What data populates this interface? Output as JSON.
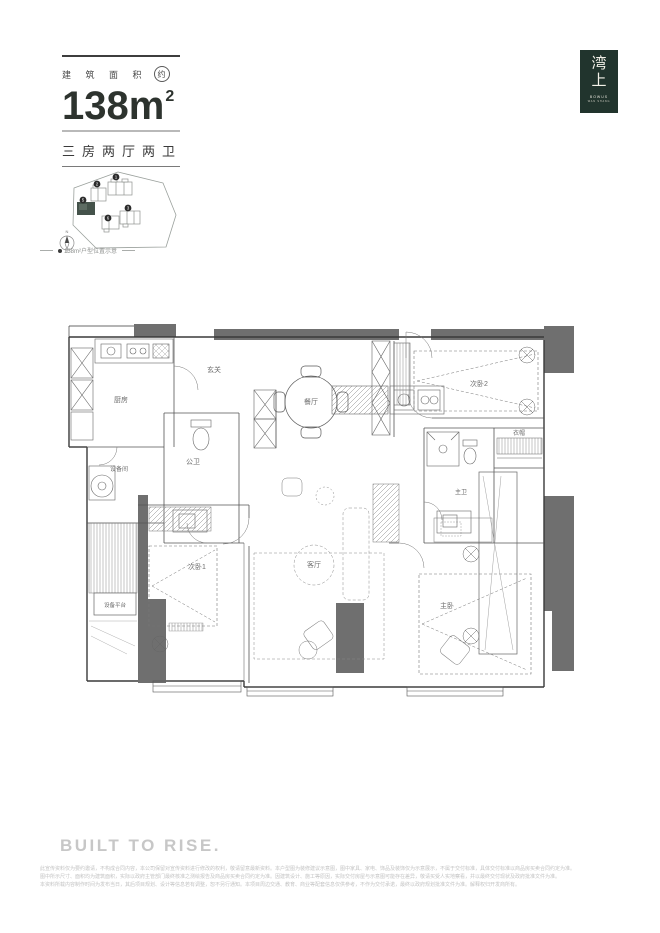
{
  "header": {
    "area_label": "建 筑 面 积",
    "area_approx": "约",
    "area_number": "138m",
    "area_sup": "2",
    "layout_text": "三房两厅两卫"
  },
  "logo": {
    "char_top": "湾",
    "char_bottom": "上",
    "sub_line1": "BOWUS",
    "sub_line2": "WAN SHANG"
  },
  "siteplan": {
    "caption": "138m²户型位置示意",
    "north_label": "N",
    "buildings": [
      {
        "num": "1"
      },
      {
        "num": "2"
      },
      {
        "num": "5"
      },
      {
        "num": "6"
      },
      {
        "num": "3"
      }
    ]
  },
  "plan": {
    "rooms": [
      {
        "name": "玄关"
      },
      {
        "name": "厨房"
      },
      {
        "name": "餐厅"
      },
      {
        "name": "公卫"
      },
      {
        "name": "设备间"
      },
      {
        "name": "次卧2"
      },
      {
        "name": "衣帽"
      },
      {
        "name": "主卫"
      },
      {
        "name": "次卧1"
      },
      {
        "name": "客厅"
      },
      {
        "name": "主卧"
      },
      {
        "name": "设备平台"
      }
    ]
  },
  "footer": {
    "slogan": "BUILT TO RISE.",
    "disclaimer_lines": [
      "此宣传资料仅为要约邀请，不构成合同内容，本公司保留对宣传资料进行修改的权利，敬请留意最新资料。本户型图为装修建议示意图，图中家具、家电、饰品及装饰仅为示意展示，不属于交付标准，具体交付标准以商品房买卖合同约定为准。",
      "图中所示尺寸、面积均为建筑面积，实际以政府主管部门最终核准之测绘报告及商品房买卖合同约定为准。因建筑设计、施工等原因，实际交付房屋与示意图可能存在差异，敬请买受人实地察看，并以最终交付现状及政府批准文件为准。",
      "本资料所载内容制作时间为发布当日，其后项目规划、设计等信息若有调整，恕不另行通知。本项目周边交通、教育、商业等配套信息仅供参考，不作为交付承诺，最终以政府规划批准文件为准。解释权归开发商所有。"
    ]
  },
  "colors": {
    "brand_green": "#21342d",
    "ink": "#2d332e",
    "wall_dark": "#6f6f6f"
  }
}
